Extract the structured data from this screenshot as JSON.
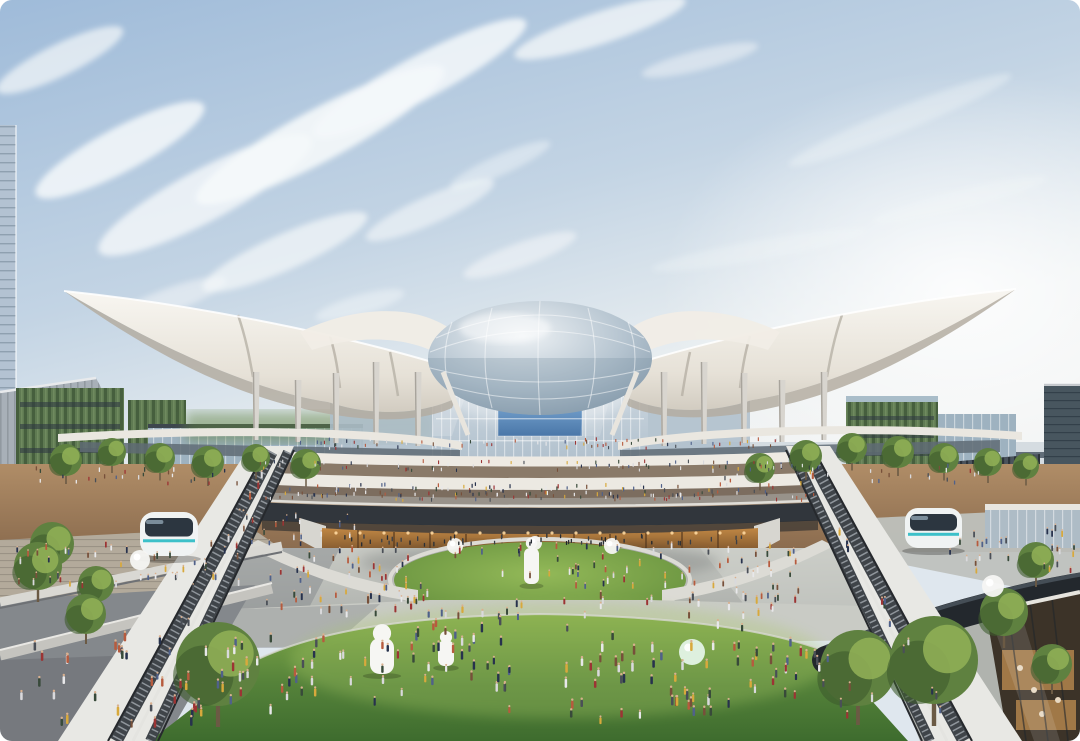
{
  "meta": {
    "type": "architectural-rendering",
    "subject": "Aerial rendering of a futuristic transit hub: white winged canopy roof over a glass dome atrium, tiered terraces, sunken oval lawn plaza, crowds, escalator ramps, autonomous shuttle pods and green-wall buildings under a blue sky",
    "width": 1080,
    "height": 741
  },
  "palette": {
    "sky_top": "#9fbbd9",
    "sky_mid": "#c3d4e4",
    "sky_bright": "#edf1f2",
    "cloud": "#f5f8fa",
    "canopy_light": "#f8f6f1",
    "canopy_mid": "#e6e1d7",
    "canopy_shadow": "#b4ada1",
    "ridge_shadow": "#b7b1a6",
    "column": "#d8d5cf",
    "column_shade": "#a8a49c",
    "dome_light": "#eef2f5",
    "dome_mid": "#b4c3cf",
    "dome_dark": "#7f94a6",
    "glass_light": "#d7e0e7",
    "glass_mid": "#aebecb",
    "screen_blue_1": "#7aa6d2",
    "screen_blue_2": "#4a77a8",
    "sign_dark": "#2e3a46",
    "fascia": "#eae7e0",
    "wood_light": "#b08d67",
    "wood_dark": "#8a6b4e",
    "concourse_warm": "#8a7a69",
    "bridge_dark": "#31363c",
    "rail_light": "#e0ded8",
    "retail_amber": "#c08744",
    "retail_dark": "#6f4a28",
    "light_warm": "#ffd9a0",
    "greenwall": "#5f7a52",
    "greenwall_dark": "#465f3e",
    "glass_bldg": "#9eb2c0",
    "tower_dark": "#48565f",
    "horizon_bldg": "#c7d1d9",
    "track_gray": "#616d78",
    "tree_light": "#8fae55",
    "tree_mid": "#5f8140",
    "tree_dark": "#3e5c2d",
    "trunk": "#6b5a44",
    "lawn_light": "#82aa4a",
    "lawn_mid": "#55823a",
    "lawn_dark": "#3e6c2e",
    "oval_light": "#93b958",
    "oval_dark": "#5f8a3a",
    "planter_white": "#dcdbd5",
    "pave_light": "#c9cbc5",
    "pave_mid": "#adb0ac",
    "pave_shadow": "#84888c",
    "parapet": "#e8e8e4",
    "channel_dark": "#3f4449",
    "step_light": "#8f959b",
    "handrail": "#26292d",
    "pod_body": "#f0f3f3",
    "pod_glass": "#2c3640",
    "pod_teal": "#3cc0c9",
    "beam_dark": "#23282d",
    "robot_white": "#f6f6f3",
    "balloon_green": "#def0de",
    "skin": "#d9b08f"
  },
  "scene": {
    "clouds": [
      {
        "x": 120,
        "y": 150,
        "rx": 95,
        "ry": 22,
        "rot": -28,
        "o": 0.85
      },
      {
        "x": 205,
        "y": 195,
        "rx": 120,
        "ry": 26,
        "rot": -28,
        "o": 0.8
      },
      {
        "x": 320,
        "y": 135,
        "rx": 140,
        "ry": 26,
        "rot": -28,
        "o": 0.9
      },
      {
        "x": 420,
        "y": 78,
        "rx": 120,
        "ry": 22,
        "rot": -28,
        "o": 0.85
      },
      {
        "x": 285,
        "y": 252,
        "rx": 90,
        "ry": 18,
        "rot": -24,
        "o": 0.7
      },
      {
        "x": 430,
        "y": 210,
        "rx": 70,
        "ry": 14,
        "rot": -24,
        "o": 0.6
      },
      {
        "x": 520,
        "y": 255,
        "rx": 60,
        "ry": 12,
        "rot": -20,
        "o": 0.55
      },
      {
        "x": 170,
        "y": 300,
        "rx": 60,
        "ry": 12,
        "rot": -20,
        "o": 0.5
      },
      {
        "x": 360,
        "y": 305,
        "rx": 46,
        "ry": 10,
        "rot": -16,
        "o": 0.45
      },
      {
        "x": 600,
        "y": 28,
        "rx": 90,
        "ry": 16,
        "rot": -18,
        "o": 0.75
      },
      {
        "x": 700,
        "y": 60,
        "rx": 60,
        "ry": 10,
        "rot": -14,
        "o": 0.5
      },
      {
        "x": 900,
        "y": 120,
        "rx": 120,
        "ry": 12,
        "rot": -22,
        "o": 0.35
      },
      {
        "x": 960,
        "y": 200,
        "rx": 90,
        "ry": 10,
        "rot": -14,
        "o": 0.3
      },
      {
        "x": 760,
        "y": 250,
        "rx": 110,
        "ry": 10,
        "rot": -10,
        "o": 0.3
      },
      {
        "x": 60,
        "y": 60,
        "rx": 70,
        "ry": 16,
        "rot": -26,
        "o": 0.7
      },
      {
        "x": 500,
        "y": 165,
        "rx": 55,
        "ry": 10,
        "rot": -24,
        "o": 0.45
      }
    ],
    "columns_left": [
      {
        "x": 256,
        "y1": 372,
        "y2": 440
      },
      {
        "x": 298,
        "y1": 380,
        "y2": 442
      },
      {
        "x": 336,
        "y1": 373,
        "y2": 443
      },
      {
        "x": 376,
        "y1": 362,
        "y2": 444
      },
      {
        "x": 418,
        "y1": 372,
        "y2": 446
      }
    ],
    "columns_right": [
      {
        "x": 664,
        "y1": 372,
        "y2": 446
      },
      {
        "x": 704,
        "y1": 362,
        "y2": 444
      },
      {
        "x": 744,
        "y1": 373,
        "y2": 443
      },
      {
        "x": 782,
        "y1": 380,
        "y2": 442
      },
      {
        "x": 824,
        "y1": 372,
        "y2": 440
      }
    ],
    "trees": [
      {
        "x": 66,
        "y": 460,
        "r": 16
      },
      {
        "x": 112,
        "y": 452,
        "r": 14
      },
      {
        "x": 160,
        "y": 458,
        "r": 15
      },
      {
        "x": 208,
        "y": 462,
        "r": 16
      },
      {
        "x": 256,
        "y": 458,
        "r": 14
      },
      {
        "x": 306,
        "y": 464,
        "r": 15
      },
      {
        "x": 760,
        "y": 468,
        "r": 15
      },
      {
        "x": 806,
        "y": 456,
        "r": 16
      },
      {
        "x": 852,
        "y": 448,
        "r": 15
      },
      {
        "x": 898,
        "y": 452,
        "r": 16
      },
      {
        "x": 944,
        "y": 458,
        "r": 15
      },
      {
        "x": 988,
        "y": 462,
        "r": 14
      },
      {
        "x": 1026,
        "y": 466,
        "r": 13
      },
      {
        "x": 52,
        "y": 544,
        "r": 22
      },
      {
        "x": 96,
        "y": 584,
        "r": 18
      },
      {
        "x": 1036,
        "y": 560,
        "r": 18
      },
      {
        "x": 218,
        "y": 664,
        "r": 42
      },
      {
        "x": 38,
        "y": 566,
        "r": 24
      },
      {
        "x": 86,
        "y": 614,
        "r": 20
      },
      {
        "x": 858,
        "y": 668,
        "r": 38
      },
      {
        "x": 934,
        "y": 660,
        "r": 44
      },
      {
        "x": 1004,
        "y": 612,
        "r": 24
      },
      {
        "x": 1052,
        "y": 664,
        "r": 20
      }
    ],
    "pods": [
      {
        "x": 140,
        "y": 512,
        "w": 58,
        "h": 44,
        "label": "autonomous-shuttle-pod"
      },
      {
        "x": 905,
        "y": 508,
        "w": 57,
        "h": 40,
        "label": "autonomous-shuttle-pod"
      }
    ],
    "sculptures": [
      {
        "type": "robot",
        "x": 370,
        "y": 626,
        "w": 24,
        "h": 48
      },
      {
        "type": "robot",
        "x": 438,
        "y": 632,
        "w": 16,
        "h": 34
      },
      {
        "type": "robot",
        "x": 524,
        "y": 536,
        "w": 15,
        "h": 48
      },
      {
        "type": "sphere",
        "x": 140,
        "y": 560,
        "r": 10
      },
      {
        "type": "sphere",
        "x": 993,
        "y": 586,
        "r": 11
      },
      {
        "type": "sphere",
        "x": 455,
        "y": 546,
        "r": 8
      },
      {
        "type": "sphere",
        "x": 535,
        "y": 543,
        "r": 7
      },
      {
        "type": "sphere",
        "x": 612,
        "y": 546,
        "r": 8
      },
      {
        "type": "balloon",
        "x": 692,
        "y": 652,
        "r": 13
      }
    ],
    "lights": {
      "from": 336,
      "to": 744,
      "step": 24,
      "y": 533
    },
    "crowds": {
      "colors": [
        "#27324d",
        "#50618a",
        "#9c3434",
        "#d9d9dc",
        "#d8a93c",
        "#77503a",
        "#384a3a",
        "#e8e8ea",
        "#b75b3e",
        "#4a4f57"
      ],
      "dark_colors": [
        "#1f242b",
        "#2b3036",
        "#3a3f46",
        "#272c33"
      ],
      "regions": [
        {
          "x": 300,
          "y": 441,
          "w": 480,
          "h": 9,
          "n": 70,
          "s": 0.5
        },
        {
          "x": 260,
          "y": 463,
          "w": 560,
          "h": 9,
          "n": 80,
          "s": 0.5
        },
        {
          "x": 285,
          "y": 486,
          "w": 510,
          "h": 12,
          "n": 90,
          "s": 0.55
        },
        {
          "x": 265,
          "y": 494,
          "w": 550,
          "h": 8,
          "n": 70,
          "s": 0.5
        },
        {
          "x": 335,
          "y": 538,
          "w": 410,
          "h": 9,
          "n": 55,
          "s": 0.6,
          "d": true
        },
        {
          "x": 440,
          "y": 548,
          "w": 200,
          "h": 42,
          "n": 30,
          "s": 0.8
        },
        {
          "x": 265,
          "y": 552,
          "w": 160,
          "h": 58,
          "n": 40,
          "s": 0.8
        },
        {
          "x": 650,
          "y": 548,
          "w": 170,
          "h": 56,
          "n": 40,
          "s": 0.8
        },
        {
          "x": 10,
          "y": 545,
          "w": 230,
          "h": 58,
          "n": 45,
          "s": 0.8
        },
        {
          "x": 950,
          "y": 530,
          "w": 125,
          "h": 44,
          "n": 28,
          "s": 0.8
        },
        {
          "x": 280,
          "y": 596,
          "w": 520,
          "h": 26,
          "n": 40,
          "s": 0.9
        },
        {
          "x": 150,
          "y": 640,
          "w": 180,
          "h": 78,
          "n": 40,
          "s": 1.1
        },
        {
          "x": 380,
          "y": 625,
          "w": 140,
          "h": 68,
          "n": 30,
          "s": 1.1
        },
        {
          "x": 560,
          "y": 640,
          "w": 160,
          "h": 78,
          "n": 40,
          "s": 1.15
        },
        {
          "x": 730,
          "y": 645,
          "w": 90,
          "h": 58,
          "n": 18,
          "s": 1.1
        },
        {
          "x": 330,
          "y": 600,
          "w": 560,
          "h": 128,
          "n": 45,
          "s": 1.0
        },
        {
          "x": 20,
          "y": 640,
          "w": 180,
          "h": 88,
          "n": 25,
          "s": 1.15
        },
        {
          "x": 240,
          "y": 518,
          "w": 120,
          "h": 28,
          "n": 20,
          "s": 0.7
        },
        {
          "x": 700,
          "y": 468,
          "w": 280,
          "h": 18,
          "n": 30,
          "s": 0.6
        },
        {
          "x": 30,
          "y": 470,
          "w": 220,
          "h": 16,
          "n": 25,
          "s": 0.6
        }
      ],
      "paths": [
        {
          "x1": 272,
          "y1": 460,
          "x2": 130,
          "y2": 730,
          "n": 12,
          "s": 0.95
        },
        {
          "x1": 800,
          "y1": 465,
          "x2": 952,
          "y2": 728,
          "n": 12,
          "s": 0.95
        }
      ]
    }
  }
}
